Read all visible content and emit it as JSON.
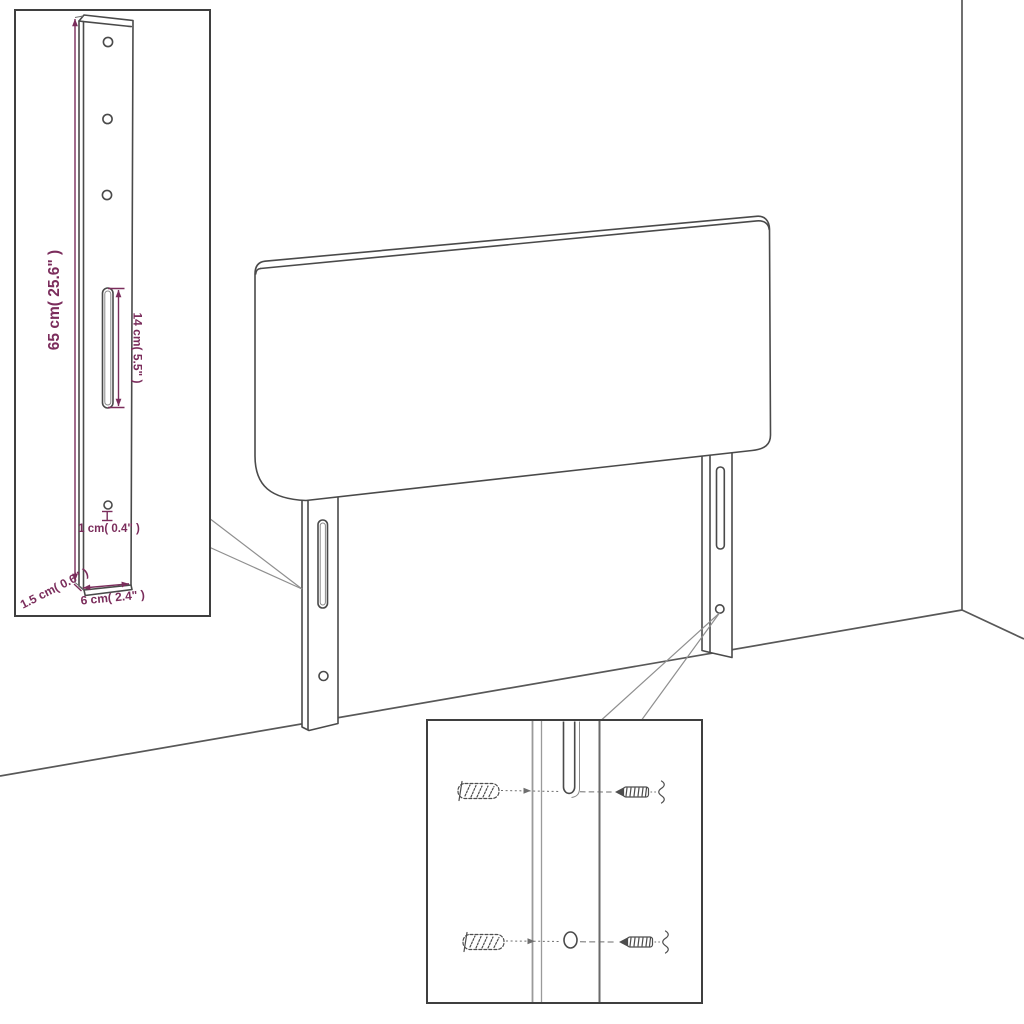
{
  "diagram": {
    "type": "furniture-assembly-diagram",
    "subject": "upholstered headboard with two slotted mounting legs in a room corner",
    "colors": {
      "background": "#ffffff",
      "outline": "#4a4a4a",
      "dimension_accent": "#7b2d5c"
    },
    "insets": {
      "leg_detail": {
        "description": "enlarged view of mounting leg with holes and slot",
        "dimensions": {
          "height": "65 cm( 25.6\" )",
          "slot_length": "14 cm( 5.5\" )",
          "hole_diameter": "1 cm( 0.4\" )",
          "width": "6 cm( 2.4\" )",
          "thickness": "1.5 cm( 0.6\" )"
        }
      },
      "mounting_detail": {
        "description": "wall plugs and screws aligned with leg slot and hole",
        "hardware": [
          "wall-plug",
          "wall-plug",
          "screw",
          "screw"
        ]
      }
    }
  }
}
